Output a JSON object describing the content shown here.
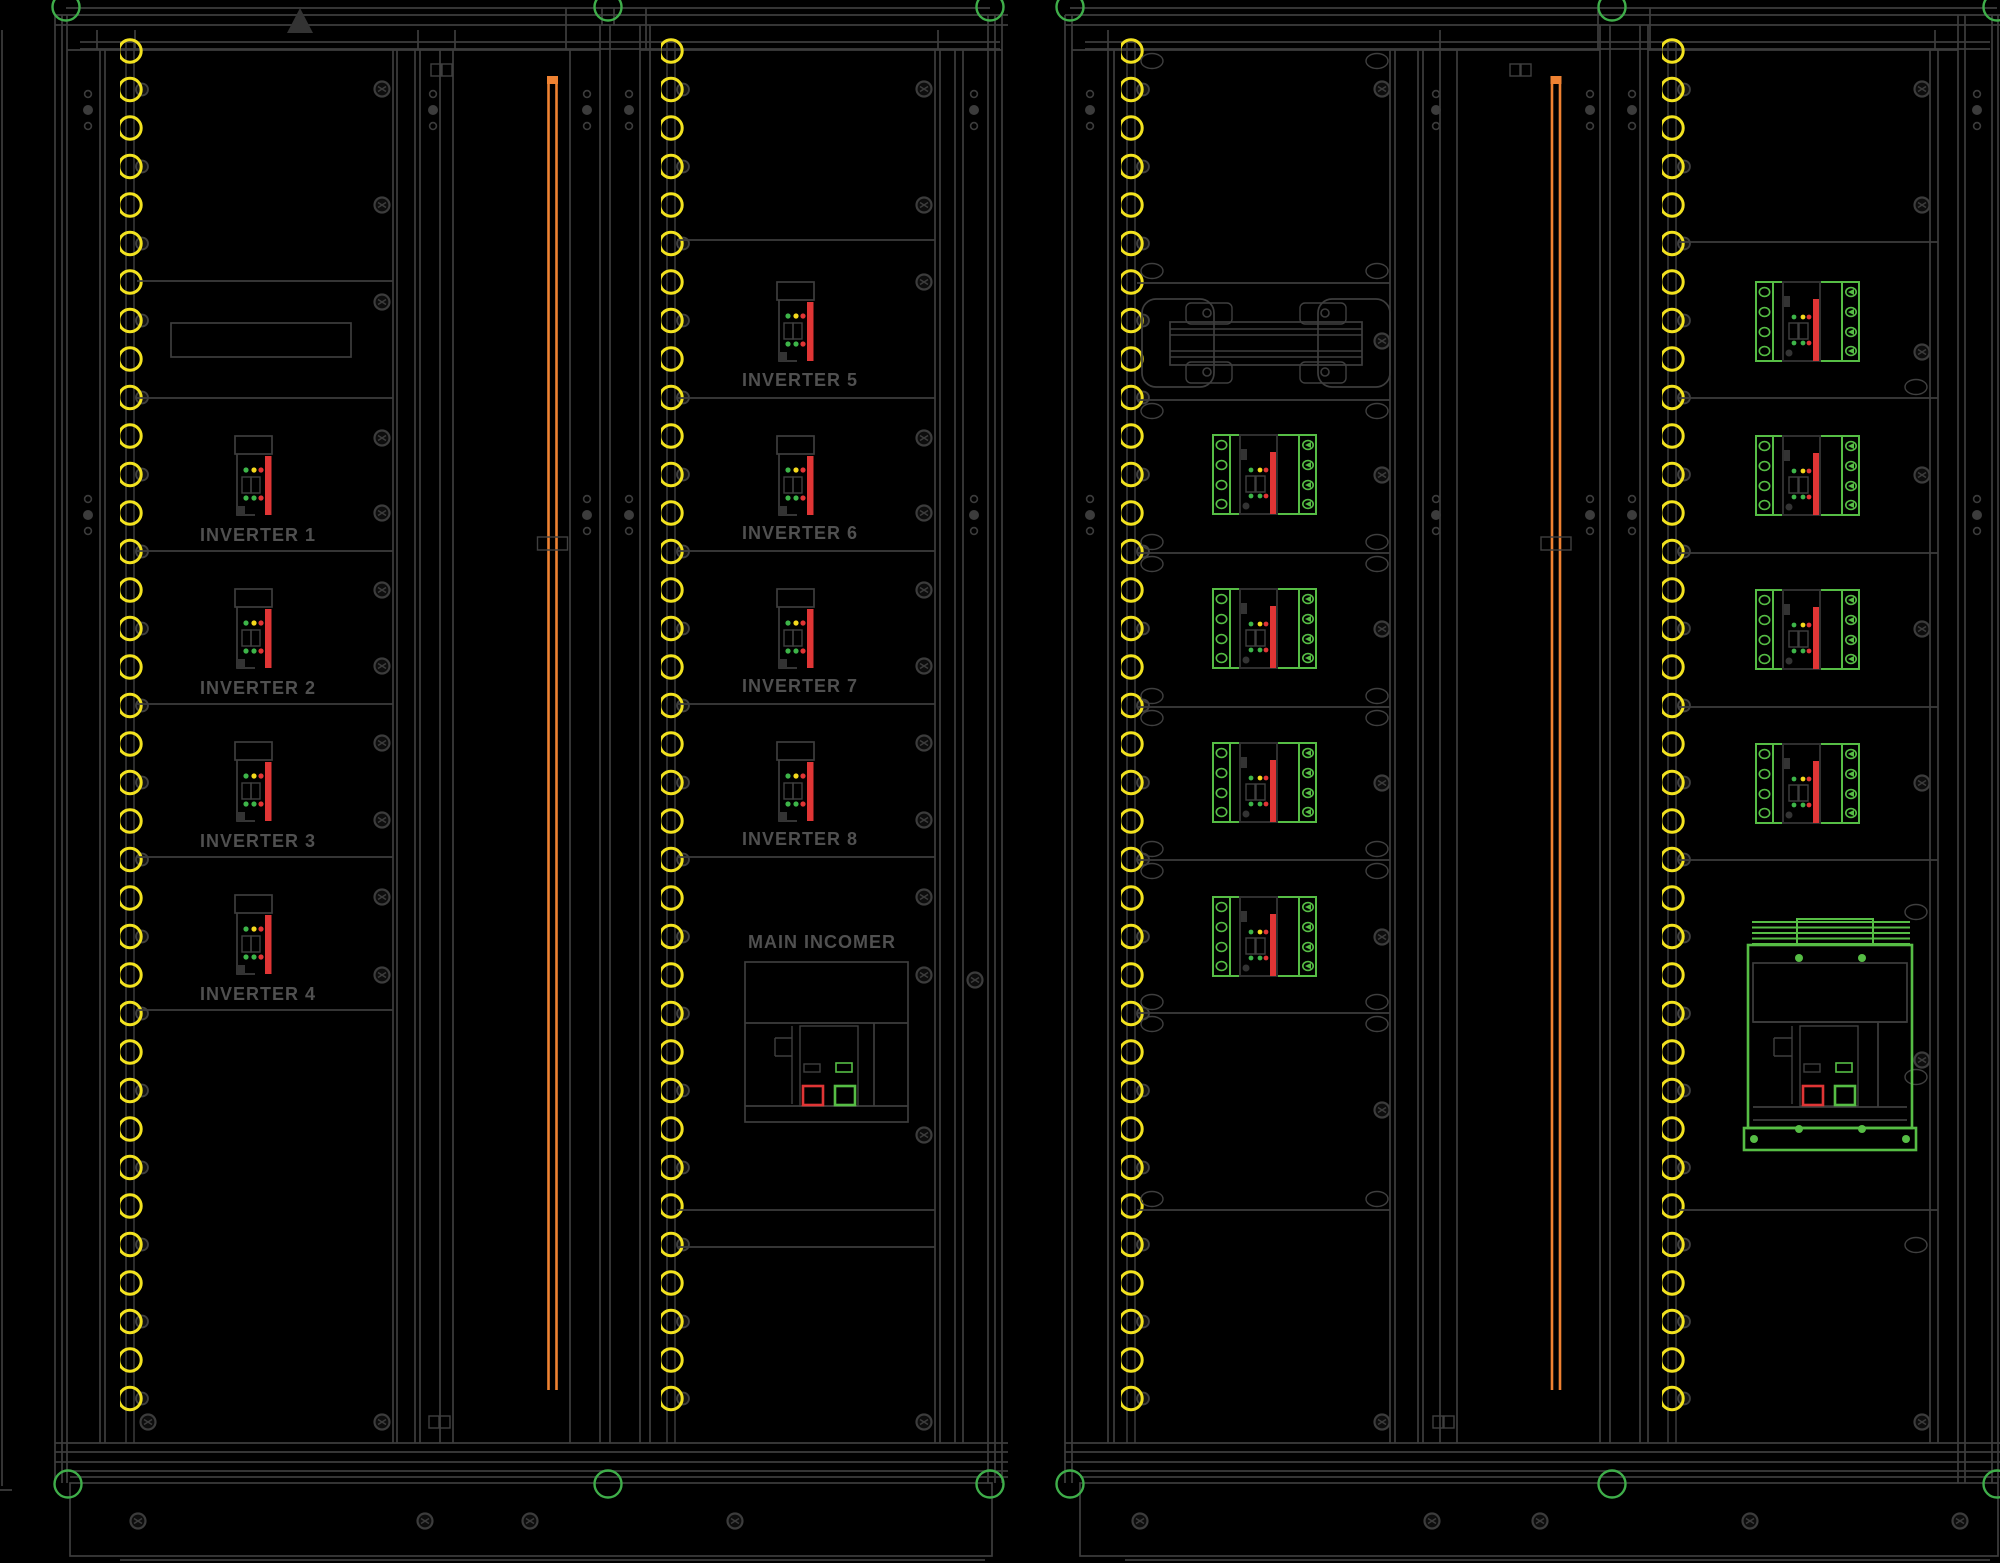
{
  "drawing": {
    "labels": {
      "inverters": [
        "INVERTER 1",
        "INVERTER 2",
        "INVERTER 3",
        "INVERTER 4",
        "INVERTER 5",
        "INVERTER 6",
        "INVERTER 7",
        "INVERTER 8"
      ],
      "main_incomer": "MAIN INCOMER"
    },
    "colors": {
      "background": "#000000",
      "frame_line": "#3d3d3d",
      "label_text": "#505050",
      "gland_yellow": "#f2e21f",
      "corner_marker_green": "#3fae4a",
      "component_green": "#56bd45",
      "alarm_red": "#e03535",
      "busbar_orange": "#ef8232",
      "indicator_green": "#3db549",
      "indicator_yellow": "#f5d91c"
    }
  }
}
